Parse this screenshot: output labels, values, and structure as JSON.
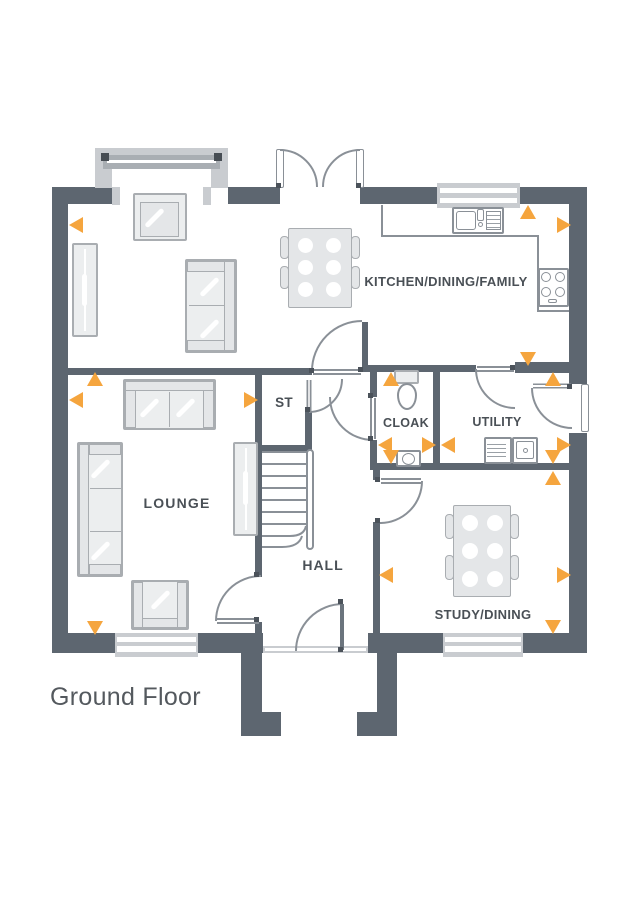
{
  "title": {
    "floor_label": "Ground Floor"
  },
  "rooms": {
    "kitchen": "KITCHEN/DINING/FAMILY",
    "lounge": "LOUNGE",
    "store": "ST",
    "cloak": "CLOAK",
    "utility": "UTILITY",
    "hall": "HALL",
    "study": "STUDY/DINING"
  },
  "colors": {
    "wall": "#5D6670",
    "marker_orange": "#F5A53E",
    "line_gray": "#8A9097",
    "furniture_fill": "#ECEEEF",
    "furniture_border": "#A9ADB1",
    "label_text": "#4A5056",
    "window_frame": "#C9CCD0",
    "title_text": "#54595E"
  },
  "markers": [
    {
      "x": 69,
      "y": 217,
      "dir": "left"
    },
    {
      "x": 557,
      "y": 217,
      "dir": "right"
    },
    {
      "x": 520,
      "y": 205,
      "dir": "up"
    },
    {
      "x": 520,
      "y": 352,
      "dir": "down"
    },
    {
      "x": 69,
      "y": 392,
      "dir": "left"
    },
    {
      "x": 244,
      "y": 392,
      "dir": "right"
    },
    {
      "x": 87,
      "y": 372,
      "dir": "up"
    },
    {
      "x": 87,
      "y": 621,
      "dir": "down"
    },
    {
      "x": 378,
      "y": 437,
      "dir": "left"
    },
    {
      "x": 422,
      "y": 437,
      "dir": "right"
    },
    {
      "x": 383,
      "y": 372,
      "dir": "up"
    },
    {
      "x": 383,
      "y": 450,
      "dir": "down"
    },
    {
      "x": 441,
      "y": 437,
      "dir": "left"
    },
    {
      "x": 557,
      "y": 437,
      "dir": "right"
    },
    {
      "x": 545,
      "y": 372,
      "dir": "up"
    },
    {
      "x": 545,
      "y": 450,
      "dir": "down"
    },
    {
      "x": 545,
      "y": 471,
      "dir": "up"
    },
    {
      "x": 545,
      "y": 620,
      "dir": "down"
    },
    {
      "x": 379,
      "y": 567,
      "dir": "left"
    },
    {
      "x": 557,
      "y": 567,
      "dir": "right"
    }
  ]
}
